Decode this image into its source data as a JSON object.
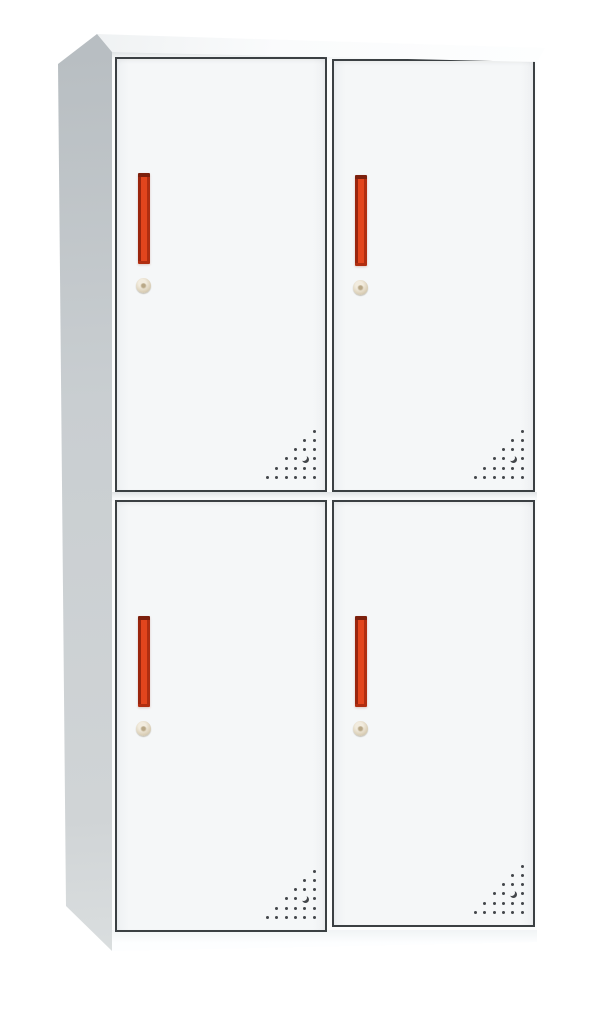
{
  "page": {
    "background": "#ffffff",
    "description": "Product photo of a white two-tier four-door steel locker cabinet with vertical red handles, round cam locks and triangular corner ventilation perforations"
  },
  "cabinet": {
    "type": "four-door-steel-locker",
    "rows": 2,
    "columns": 2,
    "door_count": 4,
    "colors": {
      "bg": "#ffffff",
      "body": "#fcfdfd",
      "door_face": "#f5f7f8",
      "door_outline": "#3b4043",
      "side_top": "#b7bdc1",
      "side_mid": "#c9ced1",
      "side_bottom": "#d0d4d6",
      "top_face_a": "#edf0f1",
      "top_face_b": "#fafbfc",
      "handle_main": "#e2451d",
      "handle_edge_dark": "#9a250e",
      "handle_shade": "#b02e11",
      "handle_cap": "#7c200d",
      "lock_light": "#f2ecdf",
      "lock_mid": "#ddd2bb",
      "lock_dark": "#bdb299",
      "vent_dot": "#43464a"
    },
    "doors": [
      {
        "position": "top-left",
        "handle": "vertical-red-bar",
        "lock": "round-cam-lock",
        "vents": "corner-perforation"
      },
      {
        "position": "top-right",
        "handle": "vertical-red-bar",
        "lock": "round-cam-lock",
        "vents": "corner-perforation"
      },
      {
        "position": "bottom-left",
        "handle": "vertical-red-bar",
        "lock": "round-cam-lock",
        "vents": "corner-perforation"
      },
      {
        "position": "bottom-right",
        "handle": "vertical-red-bar",
        "lock": "round-cam-lock",
        "vents": "corner-perforation"
      }
    ],
    "vent_pattern": {
      "rows": 6,
      "spacing": 9.3,
      "dot_size": 3,
      "layout": "right-aligned-triangle",
      "crescent": {
        "row": 3,
        "col": 1
      }
    }
  }
}
